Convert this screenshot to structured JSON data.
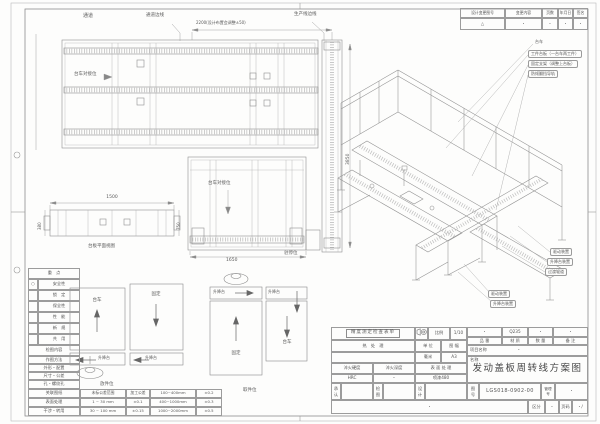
{
  "sheet": {
    "title": "发动盖板周转线方案图",
    "drawing_no": "LGS018-0902-00"
  },
  "revision_table": {
    "headers": [
      "设计变更图号",
      "变更内容",
      "页数",
      "年月日",
      "签名"
    ],
    "row": [
      "△",
      "・",
      "・",
      "・",
      "・"
    ]
  },
  "plan_view": {
    "passage": "通道",
    "passage_edge": "通道边线",
    "dim_top": "2200(设计布置会调整±50)",
    "production_edge": "生产线边线",
    "dock_label": "台车对接位",
    "dim_right": "3850",
    "dock_label2": "台车对接位",
    "dim_bottom": "1650",
    "park_label": "驻停位"
  },
  "side_view": {
    "dim_top": "1500",
    "dim_left": "380",
    "dim_right": "750",
    "caption": "台板平面视图"
  },
  "iso": {
    "callouts_top": [
      "台车",
      "工件台板（一台车两工件）",
      "固定支架（调整上台板）",
      "防倾翻挡导轨"
    ],
    "callouts_right": [
      "驱动装置",
      "升降台装置",
      "过渡辊道"
    ],
    "callouts_left": [
      "驱动装置",
      "升降台装置"
    ]
  },
  "stations": {
    "cart": "台车",
    "fixed": "固定",
    "lift": "升降台",
    "put_label": "放件位",
    "take_label": "取件位"
  },
  "check_table": {
    "key_header": "重　点",
    "key_rows": [
      {
        "mark": "○",
        "label": "安全性"
      },
      {
        "mark": "",
        "label": "锁　定"
      },
      {
        "mark": "",
        "label": "保全性"
      },
      {
        "mark": "",
        "label": "性　能"
      },
      {
        "mark": "",
        "label": "新　规"
      },
      {
        "mark": "",
        "label": "共　用"
      }
    ],
    "content_header": "检图内容",
    "content_rows": [
      "作图方法",
      "外形・配置",
      "尺寸・公差",
      "孔・螺纹孔",
      "关联图纸",
      "表面处理",
      "干涉・转用",
      "标准化"
    ]
  },
  "tolerance_table": {
    "rows": [
      [
        "未标公差范围",
        "加工公差",
        "100~400mm",
        "±0.2"
      ],
      [
        "1 ~ 30 mm",
        "±0.1",
        "400~1000mm",
        "±0.3"
      ],
      [
        "30 ~ 100 mm",
        "±0.15",
        "1000~2000mm",
        "±0.5"
      ]
    ]
  },
  "title_block": {
    "check_sheet": "精度测定检查表单",
    "scale_label": "比例",
    "scale_value": "1/10",
    "heat_label": "热　处　理",
    "unit_label": "单 位",
    "format_label": "图 幅",
    "unit_value": "毫米",
    "format_value": "A3",
    "part_label": "品 番",
    "material_label": "材 质",
    "qty_label": "数 量",
    "remark_label": "备 注",
    "part_value": "・",
    "material_value": "Q235",
    "qty_value": "・",
    "remark_value": "・",
    "project_label": "项目名称",
    "project_value": "・",
    "quench_hardness_label": "淬火硬度",
    "quench_depth_label": "淬火深度",
    "surface_label": "表 面 处 理",
    "hrc_value": "HRC",
    "depth_value": "・",
    "surface_value": "喷漆480",
    "name_label": "名称",
    "approve_label": "承认",
    "check_label": "检图",
    "design_label": "设计",
    "no_label": "图号",
    "mgmt_label": "管理号",
    "mgmt_value": "・",
    "bottom_dot": "・",
    "class_label": "区分",
    "class_value": "・",
    "page_label": "页码",
    "page_value": "・/"
  }
}
